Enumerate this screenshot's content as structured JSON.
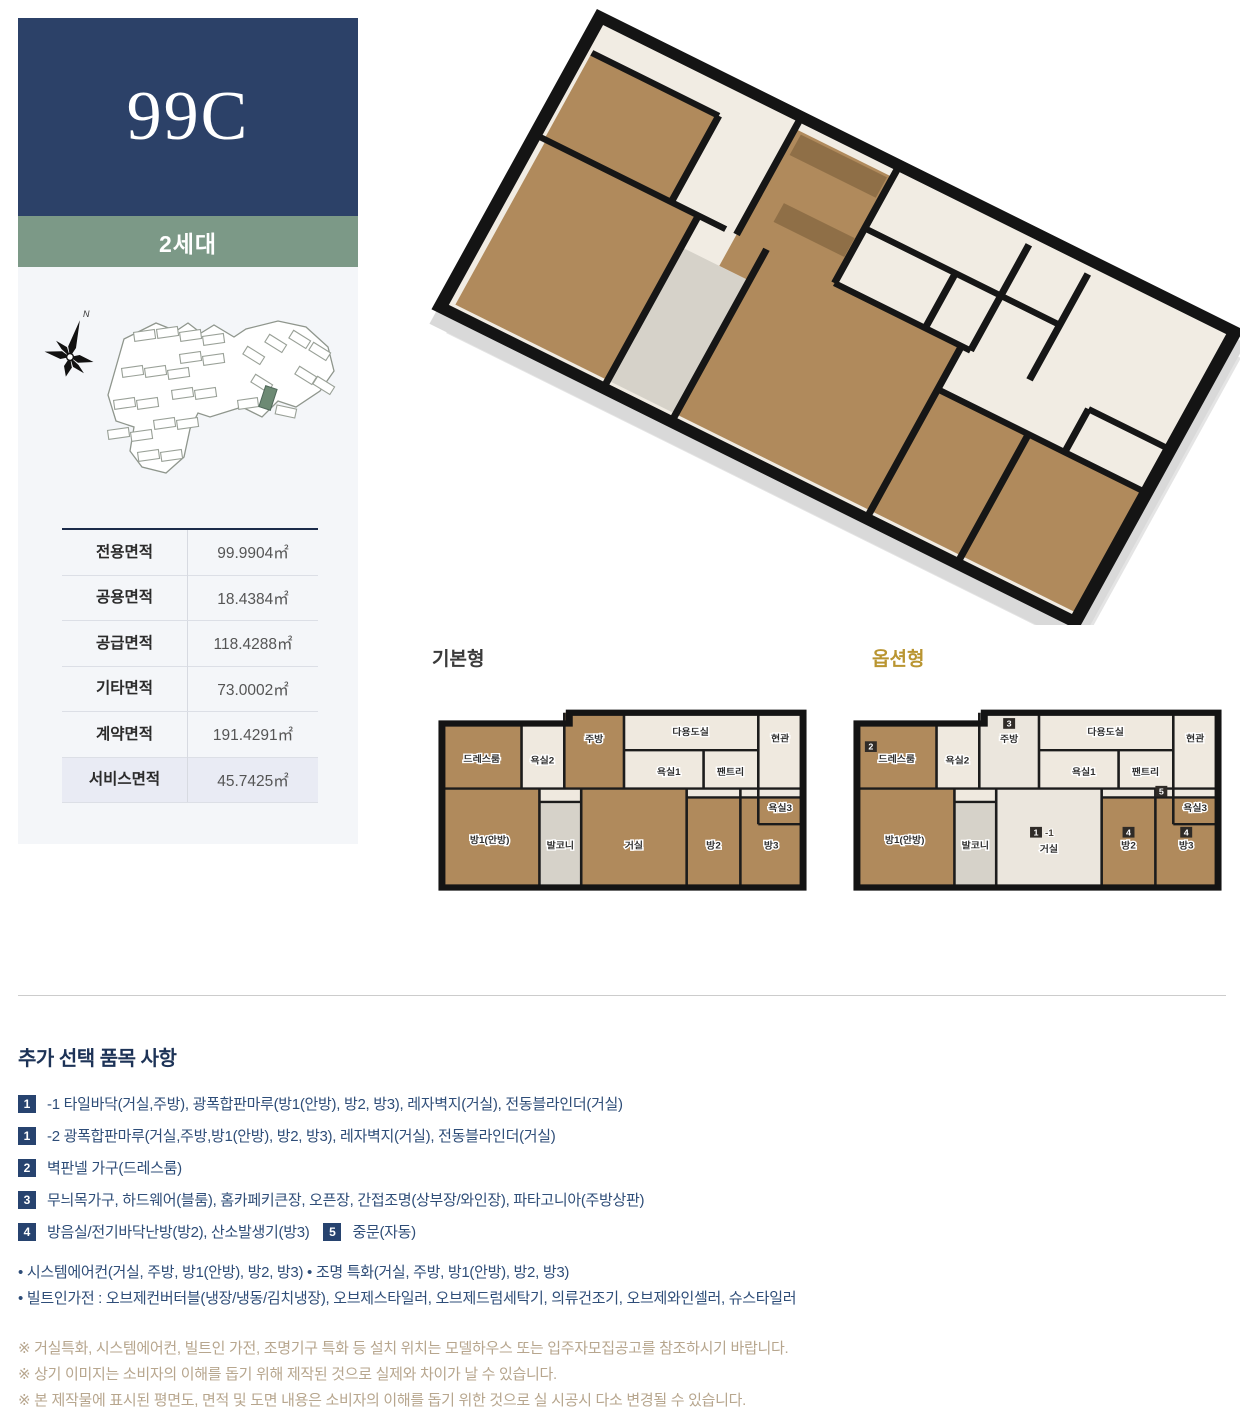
{
  "unit": {
    "code": "99C",
    "generation": "2세대"
  },
  "site_map": {
    "north_label": "N"
  },
  "area_table": {
    "rows": [
      {
        "label": "전용면적",
        "value": "99.9904㎡"
      },
      {
        "label": "공용면적",
        "value": "18.4384㎡"
      },
      {
        "label": "공급면적",
        "value": "118.4288㎡"
      },
      {
        "label": "기타면적",
        "value": "73.0002㎡"
      },
      {
        "label": "계약면적",
        "value": "191.4291㎡"
      },
      {
        "label": "서비스면적",
        "value": "45.7425㎡"
      }
    ]
  },
  "plans": {
    "basic_title": "기본형",
    "option_title": "옵션형",
    "rooms": {
      "dressroom": "드레스룸",
      "bath2": "욕실2",
      "kitchen": "주방",
      "utility": "다용도실",
      "entrance": "현관",
      "bath1": "욕실1",
      "pantry": "팬트리",
      "bath3": "욕실3",
      "room1": "방1(안방)",
      "balcony": "발코니",
      "living": "거실",
      "room2": "방2",
      "room3": "방3"
    },
    "option_badges": {
      "dressroom": "2",
      "kitchen": "3",
      "living": "1",
      "living_suffix": "-1",
      "room2": "4",
      "room3": "4",
      "door": "5"
    }
  },
  "options_section": {
    "title": "추가 선택 품목 사항",
    "items": [
      {
        "badge": "1",
        "text": "-1 타일바닥(거실,주방), 광폭합판마루(방1(안방), 방2, 방3), 레자벽지(거실), 전동블라인더(거실)"
      },
      {
        "badge": "1",
        "text": "-2 광폭합판마루(거실,주방,방1(안방), 방2, 방3), 레자벽지(거실), 전동블라인더(거실)"
      },
      {
        "badge": "2",
        "text": "벽판넬 가구(드레스룸)"
      },
      {
        "badge": "3",
        "text": "무늬목가구, 하드웨어(블룸), 홈카페키큰장, 오픈장, 간접조명(상부장/와인장), 파타고니아(주방상판)"
      },
      {
        "badge": "4",
        "text": "방음실/전기바닥난방(방2), 산소발생기(방3)",
        "badge2": "5",
        "text2": "중문(자동)"
      }
    ],
    "bullets": [
      "• 시스템에어컨(거실, 주방, 방1(안방), 방2, 방3) • 조명 특화(거실, 주방, 방1(안방), 방2, 방3)",
      "• 빌트인가전 : 오브제컨버터블(냉장/냉동/김치냉장), 오브제스타일러, 오브제드럼세탁기, 의류건조기, 오브제와인셀러, 슈스타일러"
    ],
    "disclaimers": [
      "※ 거실특화, 시스템에어컨, 빌트인 가전, 조명기구 특화 등 설치 위치는 모델하우스 또는 입주자모집공고를 참조하시기 바랍니다.",
      "※ 상기 이미지는 소비자의 이해를 돕기 위해 제작된 것으로 실제와 차이가 날 수 있습니다.",
      "※ 본 제작물에 표시된 평면도, 면적 및 도면 내용은 소비자의 이해를 돕기 위한 것으로 실 시공시 다소 변경될 수 있습니다."
    ]
  },
  "colors": {
    "navy": "#2c4168",
    "green": "#7c9987",
    "gold": "#b99531",
    "panel_bg": "#f4f6f9",
    "highlight_row": "#e9ebf4",
    "wood": "#b08a5c",
    "disclaimer_text": "#b7a68e"
  }
}
